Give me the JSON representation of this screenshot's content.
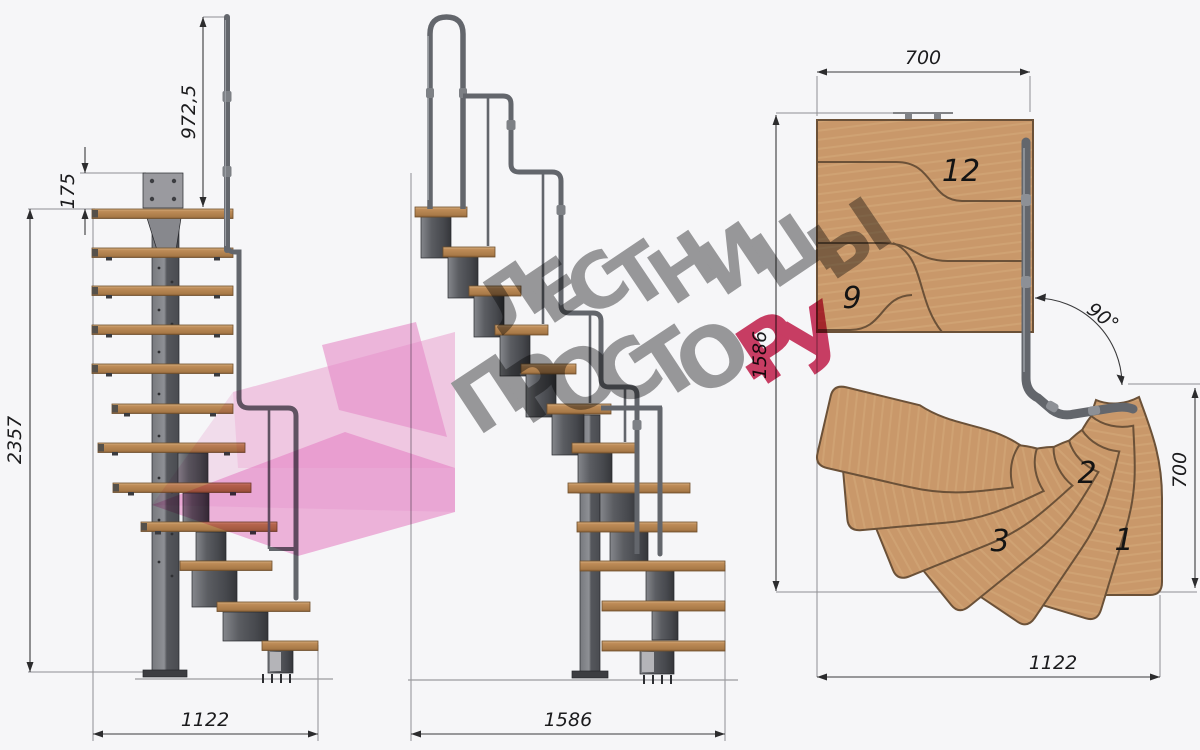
{
  "watermark": {
    "line1": "ЛЕСТНИЦЫ",
    "line2_gray": "ПРОСТО",
    "line2_red": ".РУ",
    "gray_color": "#9d9d9d",
    "red_color": "#cf3f66",
    "pink_light": "#f5b9de",
    "pink_mid": "#ec7fc6"
  },
  "front_view": {
    "dim_rail_height": "972,5",
    "dim_plate": "175",
    "dim_total_height": "2357",
    "dim_width": "1122"
  },
  "side_view": {
    "dim_length": "1586"
  },
  "plan_view": {
    "dim_width_top": "700",
    "dim_depth_left": "1586",
    "dim_angle": "90°",
    "dim_depth_right": "700",
    "dim_width_bottom": "1122",
    "step_12": "12",
    "step_9": "9",
    "step_3": "3",
    "step_2": "2",
    "step_1": "1"
  },
  "colors": {
    "wood_light": "#d2a878",
    "wood_mid": "#c08a58",
    "wood_dark": "#8f6238",
    "metal_light": "#8b8d92",
    "metal_dark": "#3f4145",
    "dim_line": "#3a3a3c"
  }
}
